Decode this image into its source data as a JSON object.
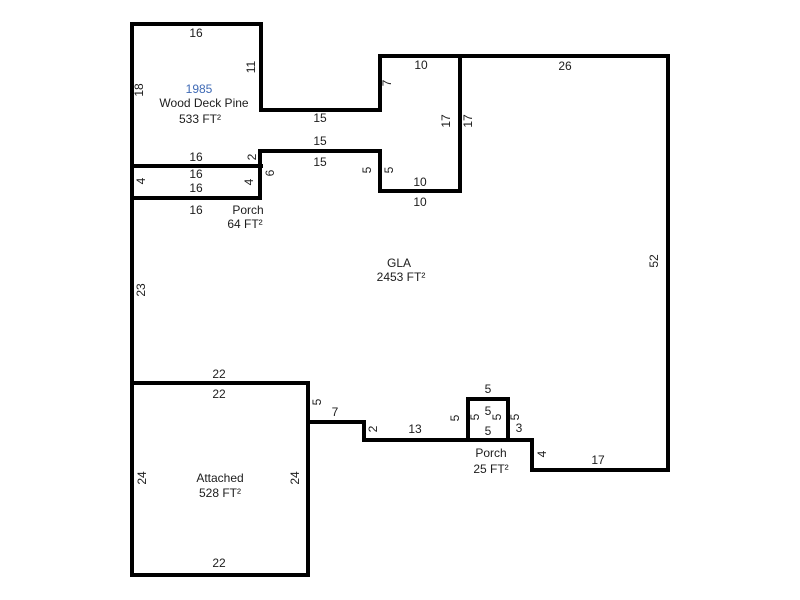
{
  "sketch": {
    "title": "Property floor plan sketch",
    "background_color": "#ffffff",
    "wall_color": "#000000",
    "wall_thickness": 4,
    "text_color": "#1c1c1c",
    "year_color": "#3f6ab5",
    "areas": [
      {
        "id": "wood-deck",
        "year": "1985",
        "label": "Wood Deck Pine",
        "area": "533 FT²"
      },
      {
        "id": "porch-64",
        "label": "Porch",
        "area": "64 FT²"
      },
      {
        "id": "gla",
        "label": "GLA",
        "area": "2453 FT²"
      },
      {
        "id": "porch-25",
        "label": "Porch",
        "area": "25 FT²"
      },
      {
        "id": "attached",
        "label": "Attached",
        "area": "528 FT²"
      }
    ],
    "walls": [
      {
        "o": "h",
        "y": 24,
        "x1": 130,
        "x2": 263
      },
      {
        "o": "h",
        "y": 56,
        "x1": 378,
        "x2": 670
      },
      {
        "o": "h",
        "y": 110,
        "x1": 259,
        "x2": 382
      },
      {
        "o": "h",
        "y": 151,
        "x1": 258,
        "x2": 382
      },
      {
        "o": "h",
        "y": 166,
        "x1": 130,
        "x2": 263
      },
      {
        "o": "h",
        "y": 191,
        "x1": 378,
        "x2": 462
      },
      {
        "o": "h",
        "y": 198,
        "x1": 130,
        "x2": 262
      },
      {
        "o": "h",
        "y": 383,
        "x1": 130,
        "x2": 310
      },
      {
        "o": "h",
        "y": 399,
        "x1": 466,
        "x2": 510
      },
      {
        "o": "h",
        "y": 422,
        "x1": 306,
        "x2": 366
      },
      {
        "o": "h",
        "y": 440,
        "x1": 362,
        "x2": 534
      },
      {
        "o": "h",
        "y": 470,
        "x1": 530,
        "x2": 670
      },
      {
        "o": "h",
        "y": 575,
        "x1": 130,
        "x2": 310
      },
      {
        "o": "v",
        "x": 132,
        "y1": 22,
        "y2": 577
      },
      {
        "o": "v",
        "x": 261,
        "y1": 22,
        "y2": 112
      },
      {
        "o": "v",
        "x": 380,
        "y1": 54,
        "y2": 112
      },
      {
        "o": "v",
        "x": 460,
        "y1": 54,
        "y2": 193
      },
      {
        "o": "v",
        "x": 380,
        "y1": 149,
        "y2": 193
      },
      {
        "o": "v",
        "x": 260,
        "y1": 149,
        "y2": 200
      },
      {
        "o": "v",
        "x": 668,
        "y1": 54,
        "y2": 472
      },
      {
        "o": "v",
        "x": 532,
        "y1": 438,
        "y2": 472
      },
      {
        "o": "v",
        "x": 364,
        "y1": 420,
        "y2": 442
      },
      {
        "o": "v",
        "x": 308,
        "y1": 381,
        "y2": 577
      },
      {
        "o": "v",
        "x": 468,
        "y1": 397,
        "y2": 442
      },
      {
        "o": "v",
        "x": 508,
        "y1": 397,
        "y2": 442
      }
    ],
    "labels": [
      {
        "t": "16",
        "x": 196,
        "y": 33
      },
      {
        "t": "10",
        "x": 421,
        "y": 65
      },
      {
        "t": "26",
        "x": 565,
        "y": 66
      },
      {
        "t": "11",
        "x": 251,
        "y": 67,
        "rot": true
      },
      {
        "t": "7",
        "x": 387,
        "y": 83,
        "rot": true
      },
      {
        "t": "1985",
        "x": 199,
        "y": 89,
        "kind": "year",
        "name": "deck-year-label"
      },
      {
        "t": "18",
        "x": 139,
        "y": 90,
        "rot": true
      },
      {
        "t": "Wood Deck Pine",
        "x": 204,
        "y": 103,
        "name": "deck-name-label"
      },
      {
        "t": "15",
        "x": 320,
        "y": 118
      },
      {
        "t": "533 FT²",
        "x": 200,
        "y": 119,
        "name": "deck-area-label"
      },
      {
        "t": "17",
        "x": 446,
        "y": 121,
        "rot": true
      },
      {
        "t": "17",
        "x": 468,
        "y": 121,
        "rot": true
      },
      {
        "t": "15",
        "x": 320,
        "y": 141
      },
      {
        "t": "16",
        "x": 196,
        "y": 157
      },
      {
        "t": "2",
        "x": 252,
        "y": 157,
        "rot": true
      },
      {
        "t": "15",
        "x": 320,
        "y": 162
      },
      {
        "t": "5",
        "x": 367,
        "y": 170,
        "rot": true
      },
      {
        "t": "5",
        "x": 389,
        "y": 170,
        "rot": true
      },
      {
        "t": "6",
        "x": 270,
        "y": 173,
        "rot": true
      },
      {
        "t": "16",
        "x": 196,
        "y": 174
      },
      {
        "t": "4",
        "x": 141,
        "y": 181,
        "rot": true
      },
      {
        "t": "4",
        "x": 249,
        "y": 182,
        "rot": true
      },
      {
        "t": "10",
        "x": 420,
        "y": 182
      },
      {
        "t": "16",
        "x": 196,
        "y": 188
      },
      {
        "t": "10",
        "x": 420,
        "y": 202
      },
      {
        "t": "16",
        "x": 196,
        "y": 210
      },
      {
        "t": "Porch",
        "x": 248,
        "y": 210,
        "name": "porch64-name-label"
      },
      {
        "t": "64 FT²",
        "x": 245,
        "y": 224,
        "name": "porch64-area-label"
      },
      {
        "t": "52",
        "x": 654,
        "y": 261,
        "rot": true
      },
      {
        "t": "GLA",
        "x": 399,
        "y": 263,
        "name": "gla-name-label"
      },
      {
        "t": "2453 FT²",
        "x": 401,
        "y": 277,
        "name": "gla-area-label"
      },
      {
        "t": "23",
        "x": 141,
        "y": 290,
        "rot": true
      },
      {
        "t": "22",
        "x": 219,
        "y": 374
      },
      {
        "t": "5",
        "x": 488,
        "y": 389
      },
      {
        "t": "22",
        "x": 219,
        "y": 394
      },
      {
        "t": "5",
        "x": 317,
        "y": 402,
        "rot": true
      },
      {
        "t": "5",
        "x": 488,
        "y": 411
      },
      {
        "t": "7",
        "x": 335,
        "y": 412
      },
      {
        "t": "5",
        "x": 475,
        "y": 417,
        "rot": true
      },
      {
        "t": "5",
        "x": 497,
        "y": 417,
        "rot": true
      },
      {
        "t": "5",
        "x": 515,
        "y": 417,
        "rot": true
      },
      {
        "t": "5",
        "x": 455,
        "y": 418,
        "rot": true
      },
      {
        "t": "3",
        "x": 519,
        "y": 428
      },
      {
        "t": "2",
        "x": 373,
        "y": 429,
        "rot": true
      },
      {
        "t": "13",
        "x": 415,
        "y": 429
      },
      {
        "t": "5",
        "x": 488,
        "y": 431
      },
      {
        "t": "Porch",
        "x": 491,
        "y": 453,
        "name": "porch25-name-label"
      },
      {
        "t": "4",
        "x": 542,
        "y": 454,
        "rot": true
      },
      {
        "t": "17",
        "x": 598,
        "y": 460
      },
      {
        "t": "25 FT²",
        "x": 491,
        "y": 469,
        "name": "porch25-area-label"
      },
      {
        "t": "24",
        "x": 142,
        "y": 478,
        "rot": true
      },
      {
        "t": "Attached",
        "x": 220,
        "y": 478,
        "name": "attached-name-label"
      },
      {
        "t": "24",
        "x": 295,
        "y": 478,
        "rot": true
      },
      {
        "t": "528 FT²",
        "x": 220,
        "y": 493,
        "name": "attached-area-label"
      },
      {
        "t": "22",
        "x": 219,
        "y": 563
      }
    ]
  }
}
